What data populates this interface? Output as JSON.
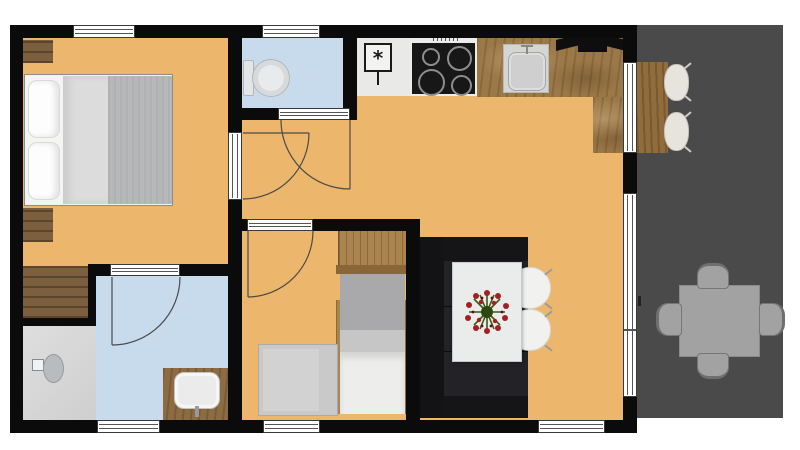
{
  "plan": {
    "kind": "floor-plan",
    "title": "",
    "rooms": [
      {
        "id": "master-bedroom",
        "label": "",
        "floor": "floor",
        "furniture": [
          "double-bed",
          "nightstand",
          "nightstand",
          "built-in-wardrobe"
        ]
      },
      {
        "id": "wc",
        "label": "",
        "floor": "bath",
        "furniture": [
          "toilet"
        ]
      },
      {
        "id": "hallway",
        "label": "",
        "floor": "floor",
        "furniture": []
      },
      {
        "id": "ensuite-bathroom",
        "label": "",
        "floor": "bath",
        "furniture": [
          "shower",
          "washbasin-vanity"
        ]
      },
      {
        "id": "kids-bedroom",
        "label": "",
        "floor": "floor",
        "furniture": [
          "wardrobe",
          "single-bed-vertical",
          "single-bed-horizontal"
        ]
      },
      {
        "id": "kitchen",
        "label": "",
        "floor": "floor",
        "furniture": [
          "freezer",
          "cooktop",
          "counter",
          "sink",
          "range-hood"
        ]
      },
      {
        "id": "living-dining",
        "label": "",
        "floor": "floor",
        "furniture": [
          "sofa",
          "dining-table",
          "chair",
          "chair",
          "flower-centerpiece"
        ]
      },
      {
        "id": "terrace",
        "label": "",
        "floor": "terrace",
        "furniture": [
          "outdoor-table",
          "outdoor-chair",
          "outdoor-chair",
          "outdoor-chair",
          "outdoor-chair",
          "bar-counter",
          "bar-stool",
          "bar-stool"
        ]
      }
    ],
    "doors": [
      {
        "id": "wc-door"
      },
      {
        "id": "master-bedroom-door"
      },
      {
        "id": "ensuite-door"
      },
      {
        "id": "kids-bedroom-door"
      }
    ],
    "windows": [
      "bedroom-window-top",
      "wc-window-top",
      "bathroom-window-bottom",
      "kids-room-window-bottom",
      "living-window-bottom",
      "kitchen-bar-window-right",
      "terrace-slider-right"
    ],
    "colors": {
      "floor": "#ecb76c",
      "bath": "#c8dbed",
      "shower": "#d9d9d9",
      "terrace": "#4a4a4b",
      "wall": "#0b0b0b",
      "sofa": "#1b1b1d",
      "bed_gray": "#b7b8b9",
      "duvet": "#ededec",
      "table_white": "#eaeceb",
      "chair_white": "#f1f1ef",
      "terrace_furniture": "#a2a2a2",
      "stool_cream": "#e7e4dd",
      "flower_red": "#a51e22",
      "flower_green": "#3c5a14",
      "window_line": "#555555",
      "door_line": "#4a4a4a",
      "freezer_symbol": "#1a1a1a"
    }
  }
}
